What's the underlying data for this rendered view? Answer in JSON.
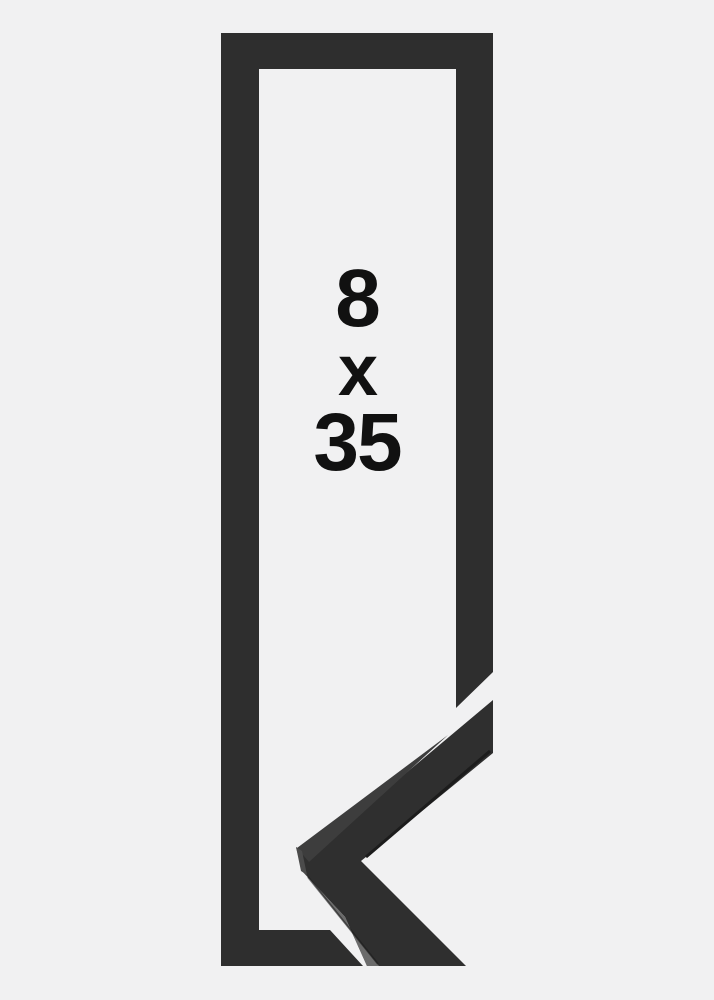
{
  "image": {
    "description": "Product photo of a tall narrow matte black picture frame shown upright; a mitred corner sample of the frame moulding profile overlaps the lower right corner, and the bottom-right sections are cut diagonally where the sample lies over the frame.",
    "size_label": {
      "width_value": "8",
      "separator": "x",
      "height_value": "35"
    }
  },
  "colors": {
    "background": "#f1f1f2",
    "frame": "#2e2e2e",
    "sample_face": "#2f2f2f",
    "sample_top_face": "#3d3d3d",
    "sample_end_face": "#4b4b4b",
    "sample_side_face": "#6b6b6b",
    "edge_shadow": "#1c1c1c",
    "label_text": "#111111"
  }
}
